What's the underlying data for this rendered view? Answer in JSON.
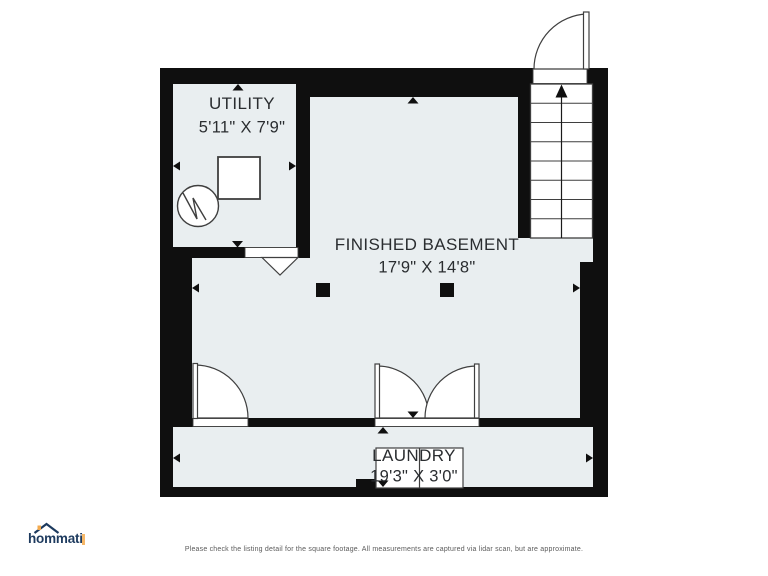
{
  "page": {
    "background_color": "#ffffff"
  },
  "floor_plan": {
    "rooms": [
      {
        "name": "UTILITY",
        "dimensions": "5'11\" X 7'9\""
      },
      {
        "name": "FINISHED BASEMENT",
        "dimensions": "17'9\" X 14'8\""
      },
      {
        "name": "LAUNDRY",
        "dimensions": "19'3\" X 3'0\""
      }
    ],
    "symbols": [
      {
        "name": "staircase-up-arrow",
        "location": "top-right"
      },
      {
        "name": "entry-door-swing",
        "location": "top-right-exterior"
      },
      {
        "name": "interior-door-swing",
        "location": "basement-to-laundry-left"
      },
      {
        "name": "double-door-swing",
        "location": "basement-to-laundry-center"
      },
      {
        "name": "cased-opening-chevron",
        "location": "utility-to-basement"
      },
      {
        "name": "water-heater",
        "location": "utility"
      },
      {
        "name": "furnace",
        "location": "utility"
      },
      {
        "name": "washer-dryer",
        "location": "laundry"
      },
      {
        "name": "support-column",
        "location": "finished-basement",
        "count": 2
      }
    ],
    "colors": {
      "wall": "#0f0f0f",
      "room_fill": "#e9eef0",
      "symbol_stroke": "#3f3f3f",
      "label_text": "#2a2d30"
    }
  },
  "branding": {
    "logo_text": "hommati",
    "logo_color": "#1d3a5e",
    "logo_accent": "#f3aa4e"
  },
  "footer": {
    "disclaimer": "Please check the listing detail for the square footage. All measurements are captured via lidar scan, but are approximate."
  }
}
